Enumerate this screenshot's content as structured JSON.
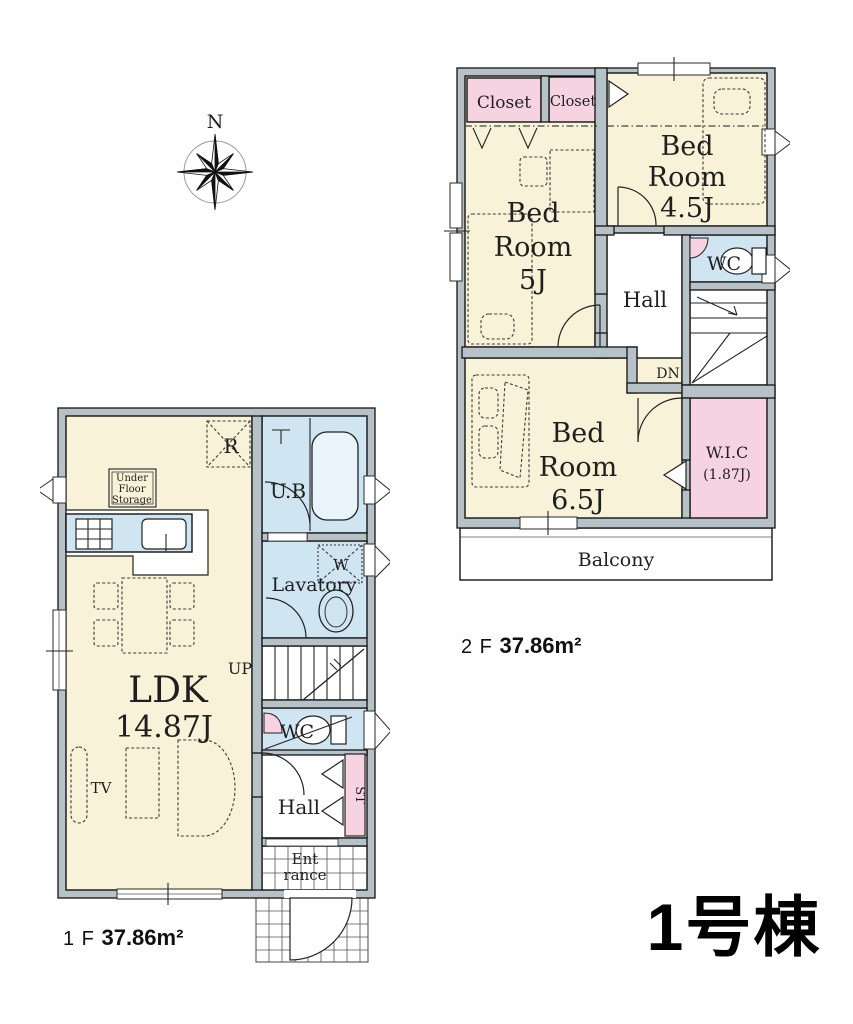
{
  "palette": {
    "room_yellow": "#f8f3d8",
    "closet_pink": "#f6d3e1",
    "wet_area_blue": "#cfe5f2",
    "wall_gray": "#b6c1c8",
    "line_black": "#141414",
    "background": "#ffffff"
  },
  "compass": {
    "north_label": "N"
  },
  "floor2": {
    "closet1_label": "Closet",
    "closet2_label": "Closet",
    "bedroom45": {
      "l1": "Bed",
      "l2": "Room",
      "l3": "4.5J"
    },
    "bedroom5": {
      "l1": "Bed",
      "l2": "Room",
      "l3": "5J"
    },
    "bedroom65": {
      "l1": "Bed",
      "l2": "Room",
      "l3": "6.5J"
    },
    "hall_label": "Hall",
    "wc_label": "WC",
    "down_label": "DN",
    "wic": {
      "l1": "W.I.C",
      "l2": "(1.87J)"
    },
    "balcony_label": "Balcony",
    "area": {
      "floor": "2 F",
      "value": "37.86m²"
    }
  },
  "floor1": {
    "ldk": {
      "l1": "LDK",
      "l2": "14.87J"
    },
    "ub_label": "U.B",
    "lavatory_label": "Lavatory",
    "washer_label": "W",
    "fridge_label": "R",
    "underfloor": {
      "l1": "Under",
      "l2": "Floor",
      "l3": "Storage"
    },
    "up_label": "UP",
    "wc_label": "WC",
    "hall_label": "Hall",
    "storage_label": "ST",
    "entrance": {
      "l1": "Ent",
      "l2": "rance"
    },
    "tv_label": "TV",
    "area": {
      "floor": "1 F",
      "value": "37.86m²"
    }
  },
  "building_label": "1号棟"
}
